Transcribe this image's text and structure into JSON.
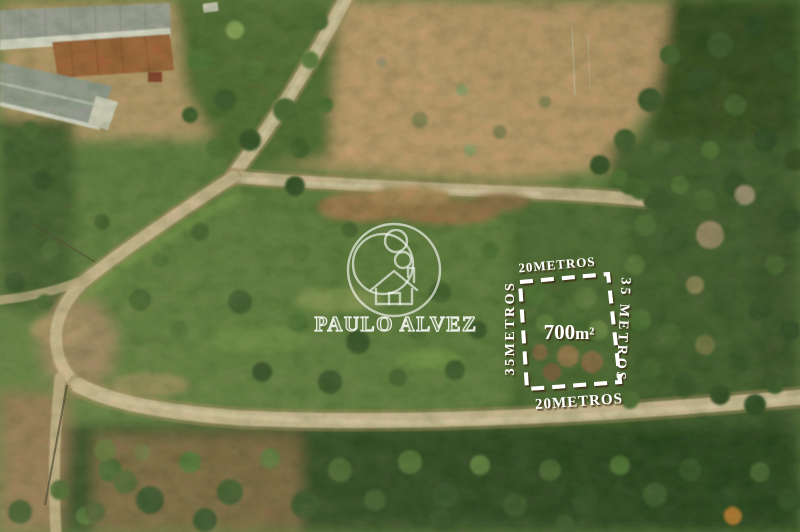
{
  "image": {
    "kind": "aerial-drone-photograph",
    "subject": "rural land plot for sale marked with dashed boundary"
  },
  "watermark": {
    "brand_name": "PAULO ALVEZ",
    "logo": "person-house-circle-realtor-logo"
  },
  "plot": {
    "area_label": {
      "value": "700",
      "unit": "m²"
    },
    "sides": {
      "top": "20METROS",
      "bottom": "20METROS",
      "left": "35METROS",
      "right": "35 METROS"
    }
  },
  "colors": {
    "annotation_text": "#ffffff",
    "annotation_shadow": "#3d2810",
    "watermark": "#ffffff",
    "dirt_road": "#d3bd98",
    "dry_field": "#c79f6f",
    "forest_dark": "#2c4621",
    "grass_mid": "#5f7c3e"
  }
}
